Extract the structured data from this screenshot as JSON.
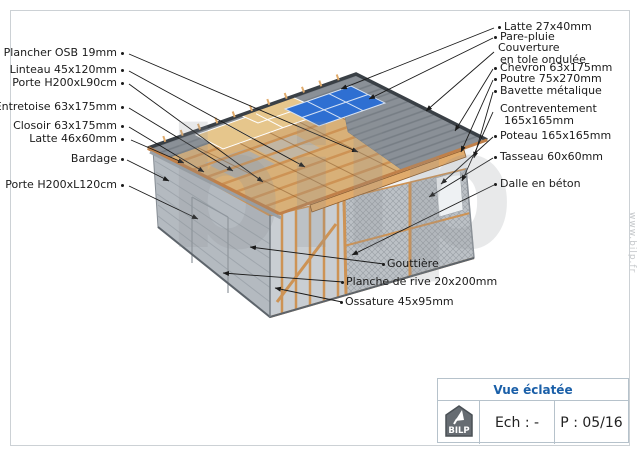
{
  "watermark": {
    "center": "bilp",
    "side": "www.bilp.fr"
  },
  "labels": {
    "left": [
      {
        "text": "Plancher OSB 19mm"
      },
      {
        "text": "Linteau 45x120mm"
      },
      {
        "text": "Porte H200xL90cm"
      },
      {
        "text": "Entretoise 63x175mm"
      },
      {
        "text": "Closoir 63x175mm"
      },
      {
        "text": "Latte 46x60mm"
      },
      {
        "text": "Bardage"
      },
      {
        "text": "Porte H200xL120cm"
      }
    ],
    "right": [
      {
        "text": "Latte 27x40mm"
      },
      {
        "text": "Pare-pluie"
      },
      {
        "line1": "Couverture",
        "line2": "en tole ondulée"
      },
      {
        "text": "Chevron 63x175mm"
      },
      {
        "text": "Poutre 75x270mm"
      },
      {
        "text": "Bavette métalique"
      },
      {
        "line1": "Contreventement",
        "line2": "165x165mm"
      },
      {
        "text": "Poteau 165x165mm"
      },
      {
        "text": "Tasseau 60x60mm"
      },
      {
        "text": "Dalle en béton"
      }
    ],
    "bottom": [
      {
        "text": "Gouttière"
      },
      {
        "text": "Planche de rive 20x200mm"
      },
      {
        "text": "Ossature 45x95mm"
      }
    ]
  },
  "title_block": {
    "title": "Vue éclatée",
    "logo_text": "BILP",
    "scale_label": "Ech : -",
    "page_label": "P : 05/16"
  },
  "colors": {
    "wood_light": "#e0ab6c",
    "wood_mid": "#cd9355",
    "wood_dark": "#8a5a2b",
    "roof_base": "#d8b078",
    "roof_gray": "#8a9097",
    "panel_blue": "#2e6fd2",
    "panel_tan": "#e6c68c",
    "wall_gray": "#b4bac0",
    "mesh_gray": "#bcc1c6",
    "leader": "#1a1a1a",
    "title_blue": "#1a5fa8"
  }
}
